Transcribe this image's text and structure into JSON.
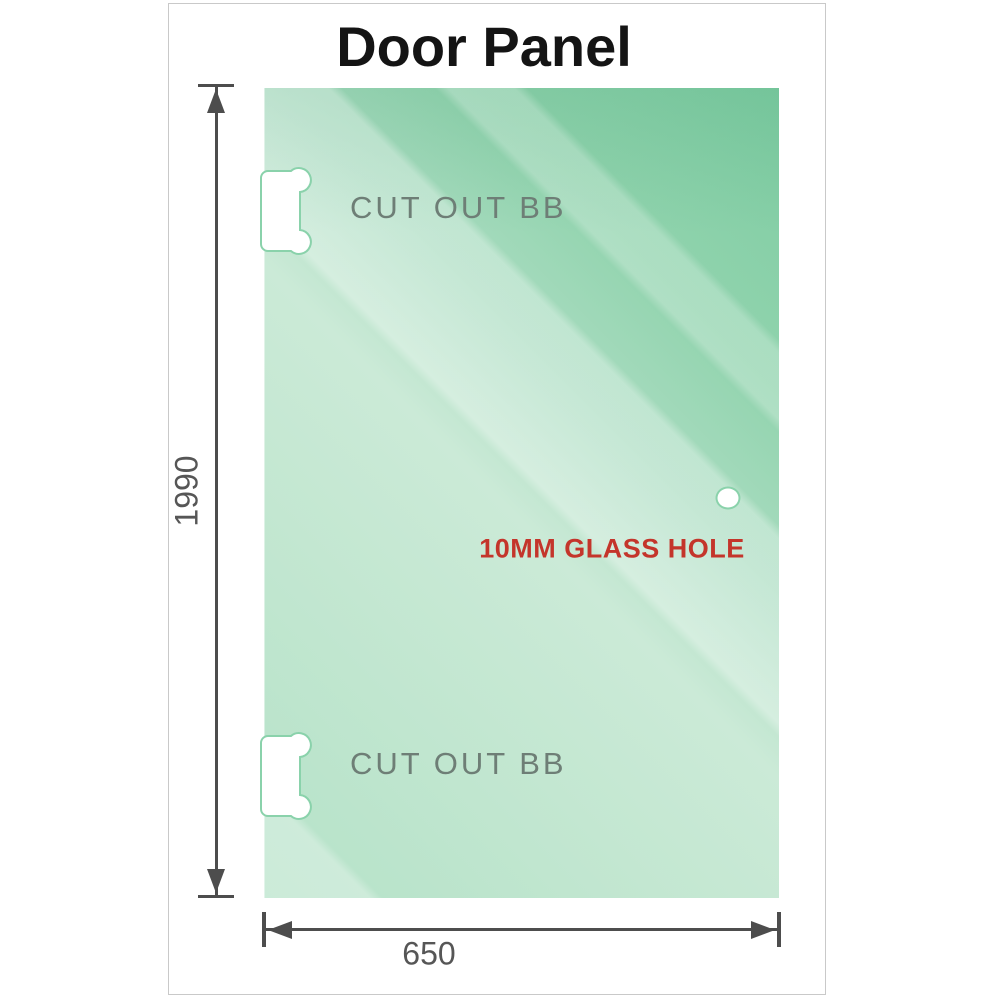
{
  "title": "Door Panel",
  "panel": {
    "description": "Glass door panel schematic",
    "cutouts": [
      {
        "label": "CUT OUT BB",
        "position": "top-left-edge"
      },
      {
        "label": "CUT OUT BB",
        "position": "bottom-left-edge"
      }
    ],
    "hole": {
      "label": "10MM GLASS HOLE",
      "position": "right-middle"
    }
  },
  "dimensions": {
    "height_mm": "1990",
    "width_mm": "650"
  },
  "colors": {
    "glass_dark": "#7ecca2",
    "glass_light": "#cbead7",
    "glass_mid": "#b5e2c8",
    "cutout_outline": "#8ad2ab",
    "dimension_line": "#4d4d4d",
    "dimension_text": "#565656",
    "cutout_label_gray": "#6e7e76",
    "hole_label_red": "#c4352b",
    "frame_border": "#c9c9c9",
    "title_color": "#141414"
  }
}
